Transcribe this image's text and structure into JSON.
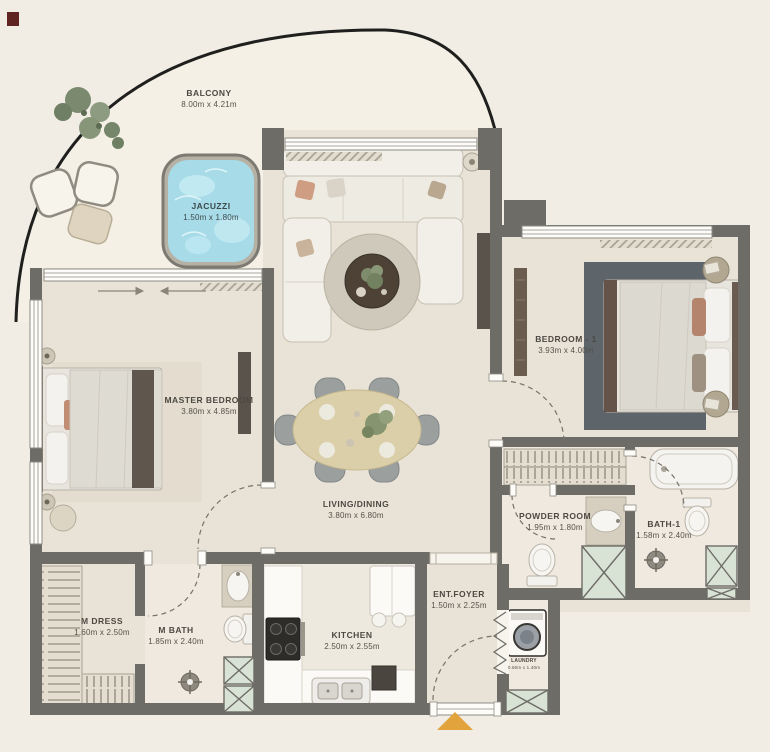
{
  "plan": {
    "type": "apartment-floor-plan",
    "colors": {
      "background": "#f1ede5",
      "balcony_floor": "#f5f0e5",
      "interior_floor": "#e9e3d7",
      "wall": "#6e6c66",
      "jacuzzi_water": "#a7dbe8",
      "shaft_green": "#d9e3d5",
      "entrance_marker_orange": "#e2a33c",
      "label_text": "#4b4942"
    }
  },
  "rooms": {
    "balcony": {
      "name": "BALCONY",
      "dims": "8.00m x 4.21m"
    },
    "jacuzzi": {
      "name": "JACUZZI",
      "dims": "1.50m x 1.80m"
    },
    "master_bedroom": {
      "name": "MASTER BEDROOM",
      "dims": "3.80m x 4.85m"
    },
    "living_dining": {
      "name": "LIVING/DINING",
      "dims": "3.80m x 6.80m"
    },
    "bedroom_1": {
      "name": "BEDROOM - 1",
      "dims": "3.93m x 4.00m"
    },
    "powder_room": {
      "name": "POWDER ROOM",
      "dims": "1.95m x 1.80m"
    },
    "bath_1": {
      "name": "BATH-1",
      "dims": "1.58m x 2.40m"
    },
    "m_dress": {
      "name": "M DRESS",
      "dims": "1.60m x 2.50m"
    },
    "m_bath": {
      "name": "M BATH",
      "dims": "1.85m x 2.40m"
    },
    "kitchen": {
      "name": "KITCHEN",
      "dims": "2.50m x 2.55m"
    },
    "ent_foyer": {
      "name": "ENT.FOYER",
      "dims": "1.50m x 2.25m"
    },
    "laundry": {
      "name": "LAUNDRY",
      "dims": "0.60m x 1.40m"
    }
  }
}
